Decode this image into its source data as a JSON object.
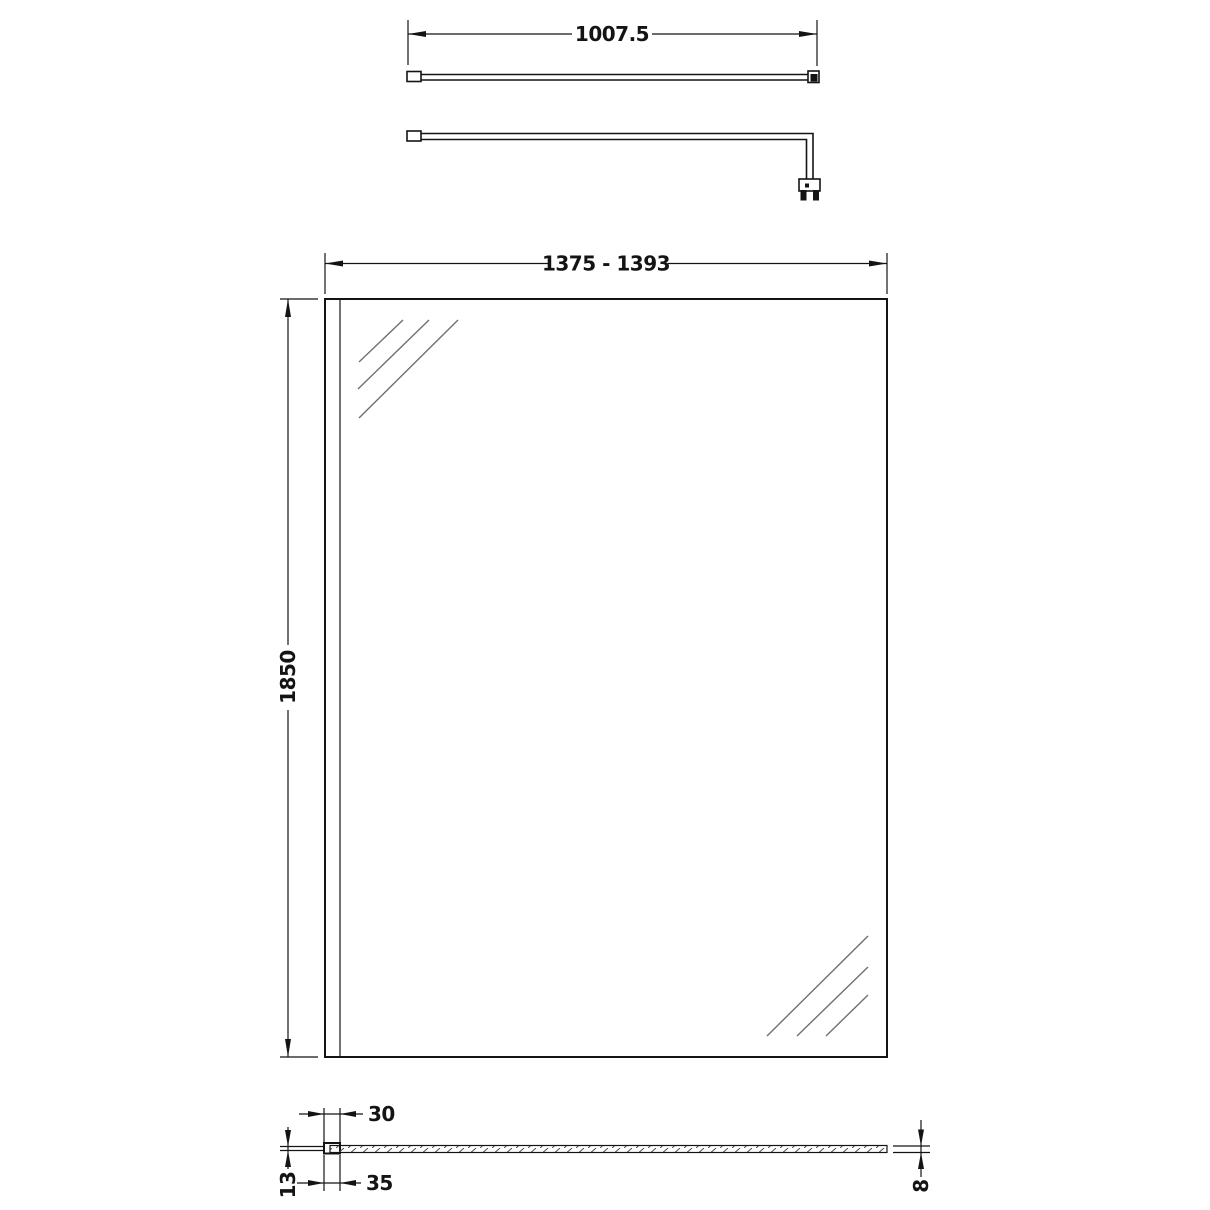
{
  "drawing": {
    "type": "technical-dimension-drawing",
    "subject": "walk-in shower glass screen with support arm",
    "background": "#ffffff",
    "line_color": "#141414",
    "reflection_color": "#707070",
    "labels": {
      "bar_length": "1007.5",
      "panel_width_range": "1375 - 1393",
      "panel_height": "1850",
      "profile_width": "30",
      "profile_overall_width": "35",
      "profile_depth": "13",
      "glass_thickness": "8"
    }
  }
}
